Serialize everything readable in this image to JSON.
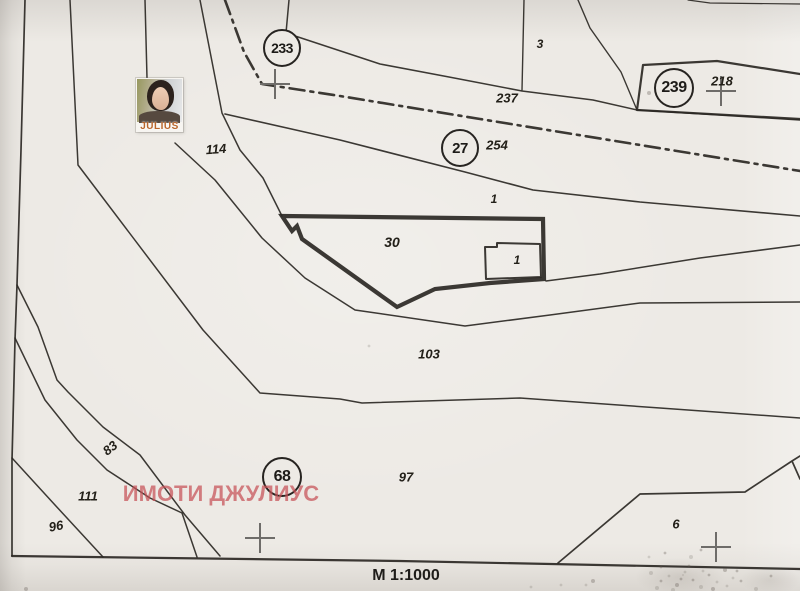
{
  "map": {
    "type": "scanned cadastral plan",
    "paper_color": "#edeae5",
    "ink_color": "#2b2824"
  },
  "plot_circles": [
    {
      "label": "233",
      "x": 282,
      "y": 48,
      "r": 17,
      "font": 14
    },
    {
      "label": "239",
      "x": 674,
      "y": 88,
      "r": 18,
      "font": 16
    },
    {
      "label": "27",
      "x": 460,
      "y": 148,
      "r": 17,
      "font": 15
    },
    {
      "label": "68",
      "x": 282,
      "y": 477,
      "r": 18,
      "font": 16
    }
  ],
  "parcel_labels": [
    {
      "text": "3",
      "x": 540,
      "y": 44,
      "size": 12,
      "rot": 0
    },
    {
      "text": "237",
      "x": 507,
      "y": 98,
      "size": 13,
      "rot": 0
    },
    {
      "text": "218",
      "x": 722,
      "y": 81,
      "size": 13,
      "rot": 0
    },
    {
      "text": "254",
      "x": 497,
      "y": 145,
      "size": 13,
      "rot": 0
    },
    {
      "text": "114",
      "x": 216,
      "y": 149,
      "size": 13,
      "rot": -4
    },
    {
      "text": "1",
      "x": 494,
      "y": 199,
      "size": 12,
      "rot": 0
    },
    {
      "text": "30",
      "x": 392,
      "y": 242,
      "size": 14,
      "rot": 0
    },
    {
      "text": "1",
      "x": 517,
      "y": 260,
      "size": 12,
      "rot": 0
    },
    {
      "text": "103",
      "x": 429,
      "y": 354,
      "size": 13,
      "rot": 0
    },
    {
      "text": "97",
      "x": 406,
      "y": 477,
      "size": 13,
      "rot": 0
    },
    {
      "text": "83",
      "x": 110,
      "y": 448,
      "size": 13,
      "rot": -38
    },
    {
      "text": "111",
      "x": 88,
      "y": 496,
      "size": 13,
      "rot": 0
    },
    {
      "text": "96",
      "x": 56,
      "y": 526,
      "size": 13,
      "rot": -10
    },
    {
      "text": "6",
      "x": 676,
      "y": 524,
      "size": 13,
      "rot": 0
    }
  ],
  "survey_crosses": [
    {
      "x": 275,
      "y": 84
    },
    {
      "x": 721,
      "y": 91
    },
    {
      "x": 260,
      "y": 538
    },
    {
      "x": 716,
      "y": 547
    }
  ],
  "watermark": {
    "text": "ИМОТИ ДЖУЛИУС",
    "x": 221,
    "y": 494,
    "size": 22,
    "color": "rgba(198,80,86,0.72)"
  },
  "scale_label": {
    "text": "М 1:1000",
    "x": 406,
    "y": 576,
    "size": 16
  },
  "photo": {
    "caption": "JULIUS",
    "caption_color": "#b9652a"
  }
}
